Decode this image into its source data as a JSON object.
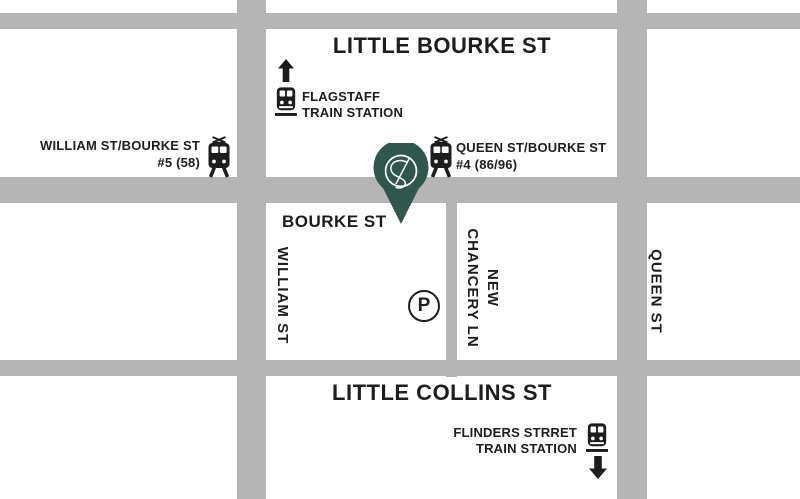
{
  "map": {
    "colors": {
      "street": "#b5b5b5",
      "pin": "#2f574e",
      "ink": "#1d1d1b",
      "bg": "#ffffff"
    },
    "streets": {
      "little_bourke": "LITTLE BOURKE ST",
      "bourke": "BOURKE ST",
      "little_collins": "LITTLE COLLINS ST",
      "william": "WILLIAM ST",
      "chancery": {
        "line1": "NEW",
        "line2": "CHANCERY LN"
      },
      "queen": "QUEEN ST"
    },
    "stations": {
      "flagstaff": {
        "name_line1": "FLAGSTAFF",
        "name_line2": "TRAIN STATION",
        "icon": "train-icon",
        "direction_icon": "arrow-up-icon"
      },
      "flinders": {
        "name_line1": "FLINDERS STRRET",
        "name_line2": "TRAIN STATION",
        "icon": "train-icon",
        "direction_icon": "arrow-down-icon"
      }
    },
    "tram_stops": {
      "william_bourke": {
        "name": "WILLIAM ST/BOURKE ST",
        "routes": "#5 (58)",
        "icon": "tram-icon"
      },
      "queen_bourke": {
        "name": "QUEEN ST/BOURKE ST",
        "routes": "#4 (86/96)",
        "icon": "tram-icon"
      }
    },
    "parking": {
      "label": "P",
      "icon": "parking-icon"
    },
    "pin": {
      "icon": "location-pin-icon"
    }
  }
}
